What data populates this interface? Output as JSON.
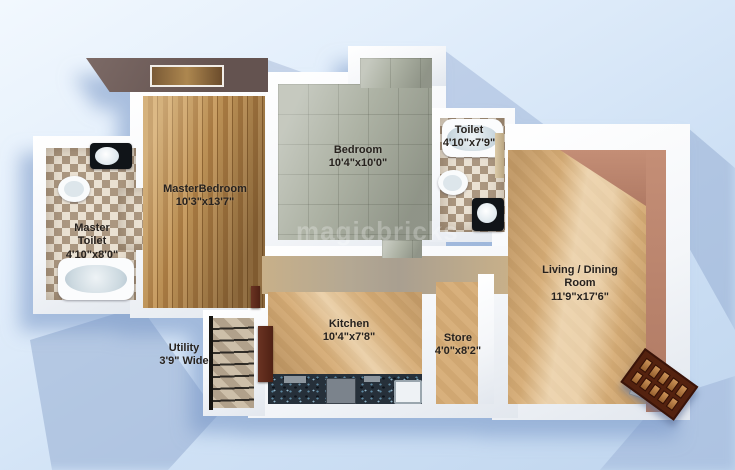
{
  "watermark": "magicbricks",
  "rooms": {
    "master_bedroom": {
      "name": "MasterBedroom",
      "dims": "10'3\"x13'7\""
    },
    "master_toilet": {
      "name_line1": "Master",
      "name_line2": "Toilet",
      "dims": "4'10\"x8'0\""
    },
    "bedroom": {
      "name": "Bedroom",
      "dims": "10'4\"x10'0\""
    },
    "toilet": {
      "name": "Toilet",
      "dims": "4'10\"x7'9\""
    },
    "living_dining": {
      "name_line1": "Living / Dining",
      "name_line2": "Room",
      "dims": "11'9\"x17'6\""
    },
    "kitchen": {
      "name": "Kitchen",
      "dims": "10'4\"x7'8\""
    },
    "store": {
      "name": "Store",
      "dims": "4'0\"x8'2\""
    },
    "utility": {
      "name": "Utility",
      "dims": "3'9\" Wide"
    }
  },
  "colors": {
    "background": "#cfe1f5",
    "wall": "#ffffff",
    "wall_accent": "#bf8772",
    "floor_wood": "#ab7c44",
    "floor_tile": "#adb2a4",
    "floor_tan": "#d8b07c",
    "floor_checker_dark": "#ab9780",
    "counter_granite": "#26303a",
    "door": "#54220f",
    "canopy": "#6f5e5b"
  }
}
